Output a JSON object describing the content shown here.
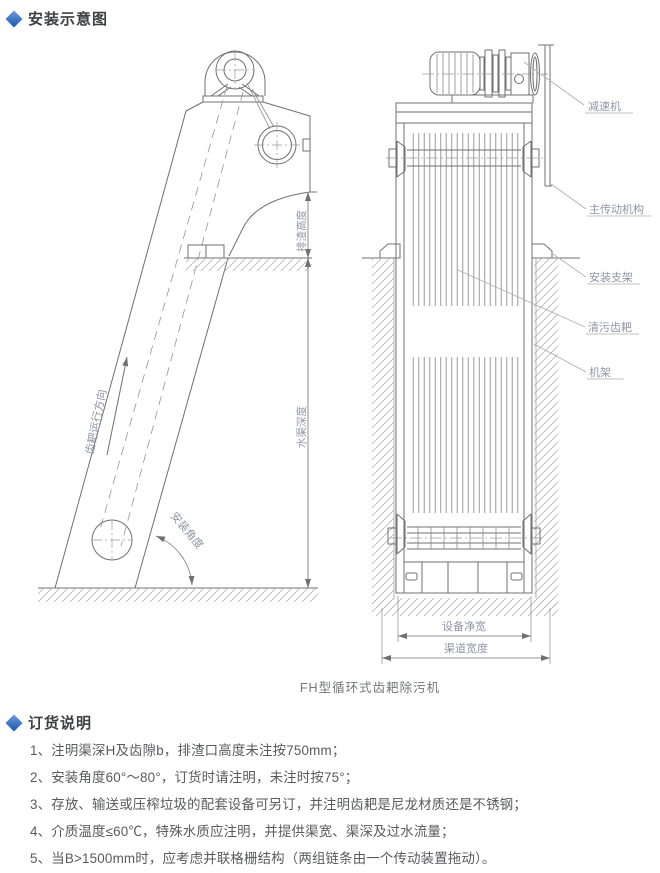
{
  "header": {
    "title": "安装示意图"
  },
  "diagram": {
    "caption": "FH型循环式齿耙除污机",
    "side_view": {
      "rake_direction": "齿耙运行方向",
      "install_angle": "安装角度",
      "discharge_height": "排渣高度",
      "channel_depth": "水渠深度"
    },
    "front_view": {
      "reducer": "减速机",
      "main_drive": "主传动机构",
      "bracket": "安装支架",
      "rake": "清污齿耙",
      "frame": "机架",
      "equip_width": "设备净宽",
      "channel_width": "渠道宽度"
    }
  },
  "ordering": {
    "title": "订货说明",
    "items": [
      "1、注明渠深H及齿隙b，排渣口高度未注按750mm；",
      "2、安装角度60°～80°，订货时请注明，未注时按75°；",
      "3、存放、输送或压榨垃圾的配套设备可另订，并注明齿耙是尼龙材质还是不锈钢；",
      "4、介质温度≤60℃，特殊水质应注明，并提供渠宽、渠深及过水流量；",
      "5、当B>1500mm时，应考虑并联格栅结构（两组链条由一个传动装置拖动）。"
    ]
  },
  "colors": {
    "accent_blue": "#2e6bc6",
    "label_gray_blue": "#8e96a6",
    "line_gray": "#707070",
    "text_gray": "#595a5c"
  }
}
